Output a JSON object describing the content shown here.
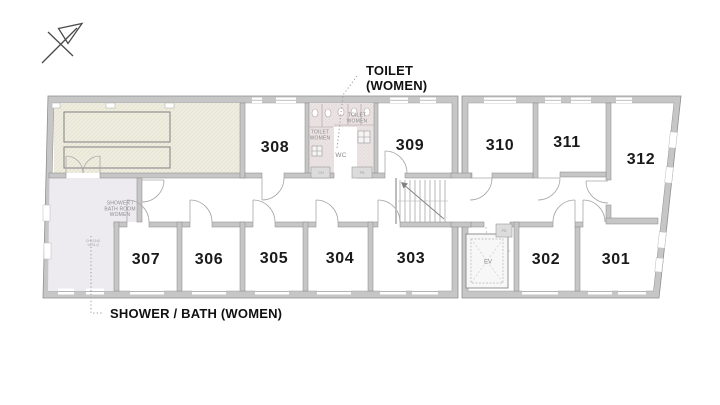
{
  "annotations": {
    "toilet": {
      "line1": "TOILET",
      "line2": "(WOMEN)"
    },
    "shower": {
      "label": "SHOWER / BATH (WOMEN)"
    }
  },
  "rooms": [
    {
      "number": "301"
    },
    {
      "number": "302"
    },
    {
      "number": "303"
    },
    {
      "number": "304"
    },
    {
      "number": "305"
    },
    {
      "number": "306"
    },
    {
      "number": "307"
    },
    {
      "number": "308"
    },
    {
      "number": "309"
    },
    {
      "number": "310"
    },
    {
      "number": "311"
    },
    {
      "number": "312"
    }
  ],
  "plan_labels": {
    "toilet_left": {
      "line1": "TOILET",
      "line2": "WOMEN"
    },
    "toilet_right": {
      "line1": "TOILET",
      "line2": "WOMEN"
    },
    "wc": "WC",
    "shower_room": {
      "line1": "SHOWER /",
      "line2": "BATH ROOM",
      "line3": "WOMEN"
    },
    "shower_note": {
      "line1": "CH=2140",
      "line2": "14.31㎡"
    },
    "elevator": "EV",
    "duct_left": "CH",
    "duct_right": "PS",
    "duct_ev": "PS"
  },
  "icons": {
    "north_arrow": "north-arrow"
  },
  "colors": {
    "background": "#ffffff",
    "wall_fill": "#c6c6c6",
    "wall_edge": "#8f8f8f",
    "lounge_fill": "#f0ede1",
    "lounge_hatch": "#ddd7c2",
    "shower_fill": "#edeaf0",
    "toilet_fill": "#ece5e5",
    "toilet_hatch": "#dcd0d0",
    "room_number_color": "#1a1a1a",
    "annotation_color": "#111111",
    "small_label_color": "#8d8d8d"
  }
}
